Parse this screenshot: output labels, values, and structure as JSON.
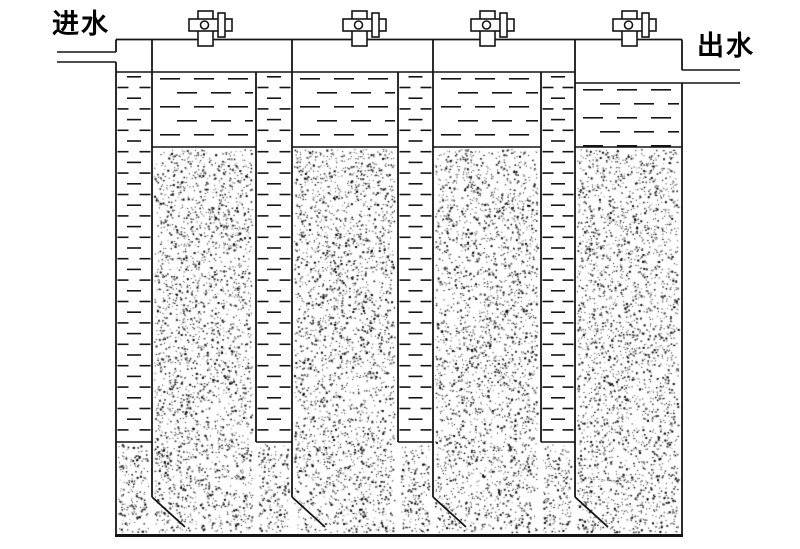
{
  "page": {
    "background": "#ffffff",
    "width": 800,
    "height": 549
  },
  "labels": {
    "inlet": "进水",
    "outlet": "出水"
  },
  "diagram": {
    "type": "schematic-cross-section",
    "colors": {
      "line": "#141414",
      "background": "#ffffff",
      "stipple": "#141414"
    },
    "counts": {
      "top_valves": 4,
      "downcomer_channels": 4,
      "media_chambers": 4
    }
  }
}
